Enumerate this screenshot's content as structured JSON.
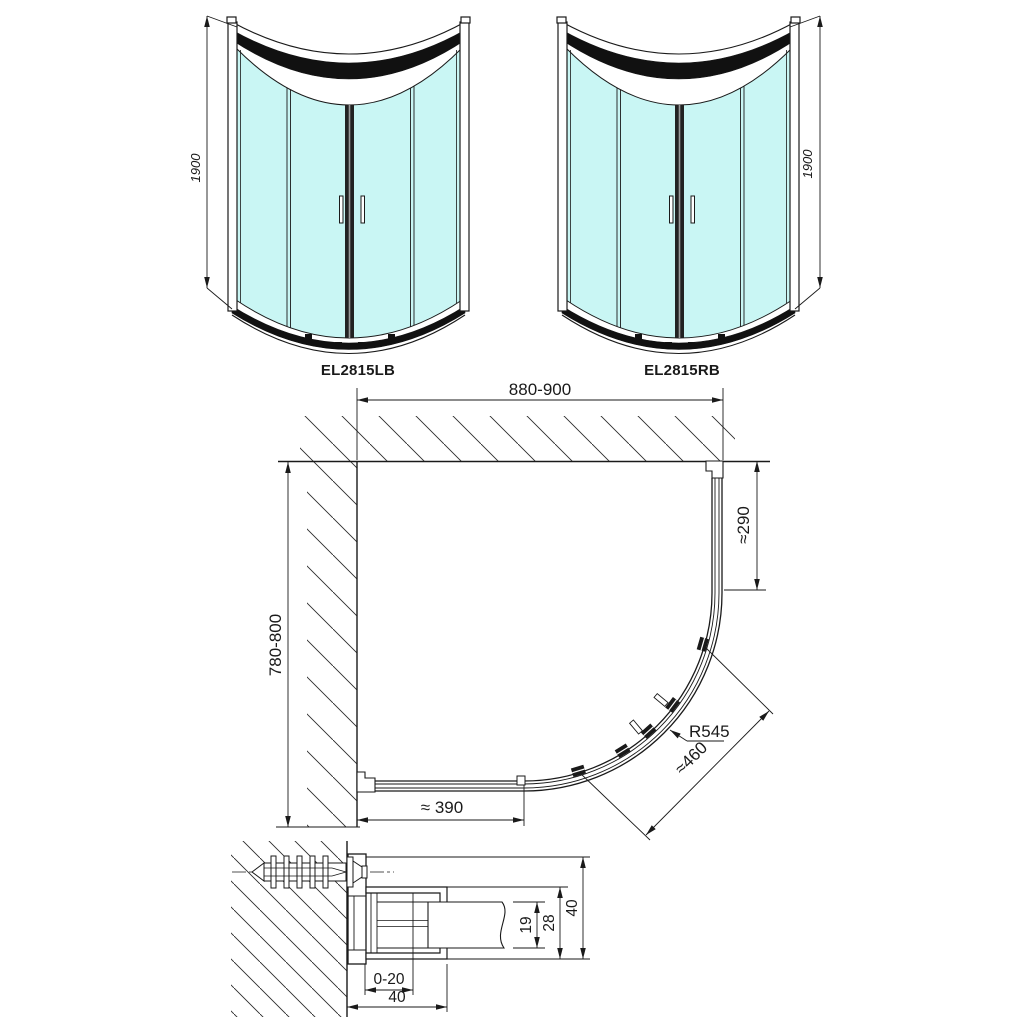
{
  "front_views": {
    "left": {
      "label": "EL2815LB",
      "height": "1900"
    },
    "right": {
      "label": "EL2815RB",
      "height": "1900"
    }
  },
  "plan_view": {
    "width": "880-900",
    "depth": "780-800",
    "right_offset": "≈290",
    "radius": "R545",
    "arc_length": "≈460",
    "opening": "≈ 390"
  },
  "section_detail": {
    "glass_slot": "19",
    "frame_inner": "28",
    "profile_depth": "40",
    "adjustment": "0-20",
    "profile_width": "40"
  },
  "colors": {
    "glass": "#c9f6f4",
    "line": "#1a1a1a"
  }
}
